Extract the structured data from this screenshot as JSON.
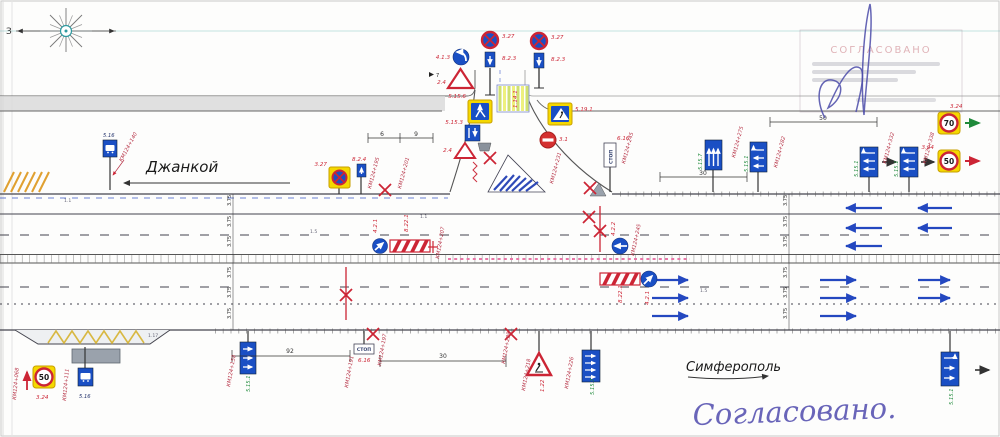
{
  "compass": {
    "west": "З"
  },
  "destinations": {
    "left": "Джанкой",
    "right": "Симферополь"
  },
  "approval": {
    "stamp_title": "СОГЛАСОВАНО",
    "handwritten": "Согласовано."
  },
  "signs": {
    "no_stop_a": {
      "code": "3.27",
      "plate": "8.2.3"
    },
    "no_stop_b": {
      "code": "3.27",
      "plate": "8.2.3"
    },
    "turn_left": {
      "code": "4.1.3",
      "note": "7"
    },
    "give_way_top": {
      "code": "2.4"
    },
    "lane_merge": {
      "code": "5.15.6"
    },
    "ped_crossing": {
      "code": "5.19.1"
    },
    "lane_start": {
      "code": "5.15.3"
    },
    "give_way_side": {
      "code": "2.4"
    },
    "no_entry": {
      "code": "3.1"
    },
    "no_stop_left": {
      "code": "3.27",
      "plate": "8.2.4"
    },
    "bus_stop_top": {
      "code": "5.16"
    },
    "stop_line_top": {
      "code": "6.16",
      "text": "СТОП"
    },
    "lanes_1": {
      "code": "5.15.7"
    },
    "lanes_2": {
      "code": "5.15.1"
    },
    "lanes_3": {
      "code": "5.15.1"
    },
    "lanes_4": {
      "code": "5.15.1"
    },
    "speed_70": {
      "code": "3.24",
      "value": "70"
    },
    "speed_50_right": {
      "code": "3.24",
      "value": "50"
    },
    "stop_line_bottom": {
      "code": "6.16",
      "text": "СТОП"
    },
    "lanes_bottom_left": {
      "code": "5.15.1"
    },
    "warning_bottom": {
      "code": "1.22"
    },
    "lanes_bottom_mid": {
      "code": "5.15.7"
    },
    "lanes_bottom_right": {
      "code": "5.15.1"
    },
    "speed_50_bottom": {
      "code": "3.24",
      "value": "50"
    },
    "bus_stop_bottom": {
      "code": "5.16"
    },
    "avoid_obstacle_left_cw": {
      "code": "4.2.1"
    },
    "avoid_obstacle_median": {
      "code": "4.2.2"
    },
    "avoid_obstacle_right_cw": {
      "code": "4.2.1"
    },
    "barrier_left": {
      "code": "8.22.1"
    },
    "barrier_right": {
      "code": "8.22.1"
    }
  },
  "markings": {
    "zebra": "1.14.1",
    "zigzag": "1.17",
    "line_a": "1.1",
    "line_b": "1.5",
    "line_c": "1.1",
    "line_d": "1.5"
  },
  "km_labels": [
    "КМ124+140",
    "КМ124+195",
    "КМ124+201",
    "КМ124+231",
    "КМ124+207",
    "КМ124+245",
    "КМ124+245",
    "КМ124+275",
    "КМ124+282",
    "КМ124+332",
    "КМ124+338",
    "КМ124+068",
    "КМ124+111",
    "КМ124+158",
    "КМ124+191",
    "КМ124+197",
    "КМ124+228",
    "КМ124+218",
    "КМ124+226"
  ],
  "dimensions": {
    "a": "6",
    "b": "9",
    "c": "50",
    "d": "30",
    "e": "92",
    "f": "30"
  },
  "lane_width": "3.75"
}
